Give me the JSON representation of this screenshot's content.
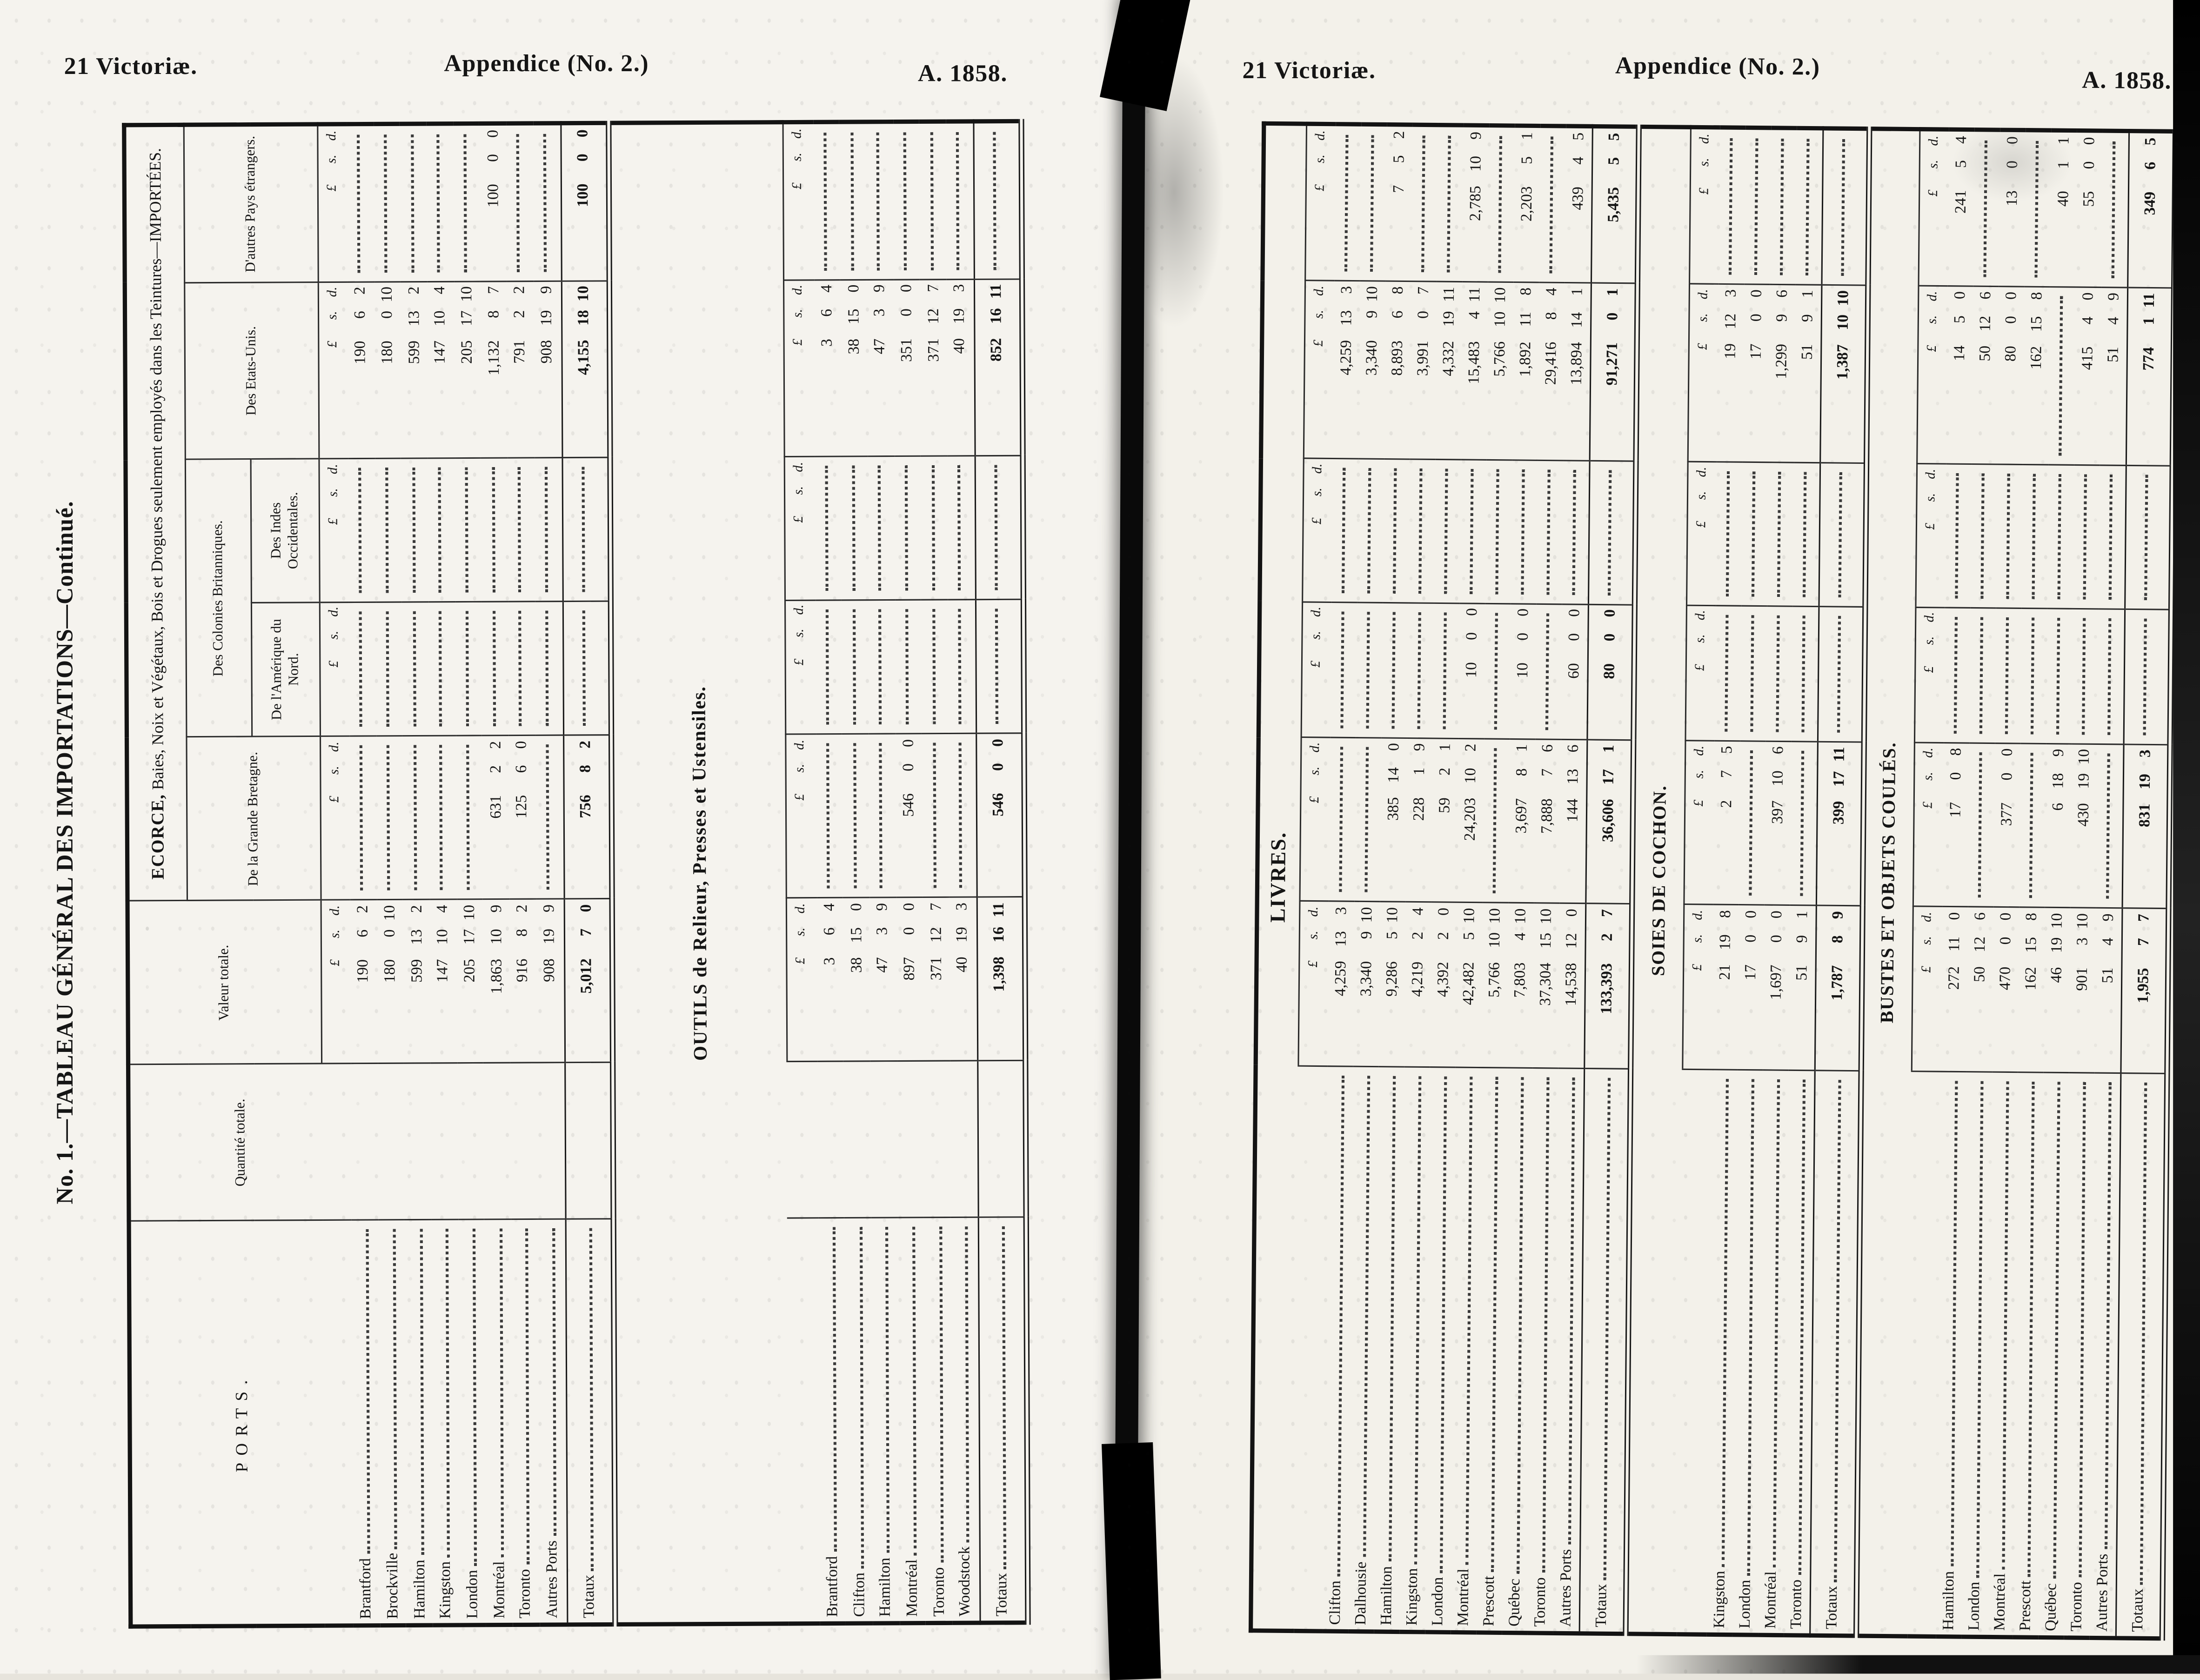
{
  "scan": {
    "header_left": "21 Victoriæ.",
    "header_center": "Appendice (No. 2.)",
    "header_right": "A. 1858.",
    "side_title": "No. 1.—TABLEAU GÉNÉRAL DES IMPORTATIONS—Continué."
  },
  "columns": {
    "ports": "PORTS.",
    "quantite": "Quantité totale.",
    "valeur": "Valeur totale.",
    "grande_bretagne": "De la Grande Bretagne.",
    "colonies": "Des Colonies Britanniques.",
    "amerique_nord": "De l'Amérique du Nord.",
    "indes_occidentales": "Des Indes Occidentales.",
    "etats_unis": "Des Etats-Unis.",
    "autres_pays": "D'autres Pays étrangers.",
    "totaux_label": "Totaux",
    "currency": {
      "l": "£",
      "s": "s.",
      "d": "d."
    }
  },
  "left_page": {
    "group_title_caps": "ECORCE,",
    "group_title_rest": " Baies, Noix et Végétaux, Bois et Drogues seulement employés dans les Teintures—IMPORTÉES.",
    "sections": [
      {
        "title": "",
        "rows": [
          {
            "port": "Brantford",
            "valeur": "190 6 2",
            "gb": "",
            "am": "",
            "in": "",
            "eu": "190 6 2",
            "au": ""
          },
          {
            "port": "Brockville",
            "valeur": "180 0 10",
            "gb": "",
            "am": "",
            "in": "",
            "eu": "180 0 10",
            "au": ""
          },
          {
            "port": "Hamilton",
            "valeur": "599 13 2",
            "gb": "",
            "am": "",
            "in": "",
            "eu": "599 13 2",
            "au": ""
          },
          {
            "port": "Kingston",
            "valeur": "147 10 4",
            "gb": "",
            "am": "",
            "in": "",
            "eu": "147 10 4",
            "au": ""
          },
          {
            "port": "London",
            "valeur": "205 17 10",
            "gb": "",
            "am": "",
            "in": "",
            "eu": "205 17 10",
            "au": ""
          },
          {
            "port": "Montréal",
            "valeur": "1,863 10 9",
            "gb": "631 2 2",
            "am": "",
            "in": "",
            "eu": "1,132 8 7",
            "au": "100 0 0"
          },
          {
            "port": "Toronto",
            "valeur": "916 8 2",
            "gb": "125 6 0",
            "am": "",
            "in": "",
            "eu": "791 2 2",
            "au": ""
          },
          {
            "port": "Autres Ports",
            "valeur": "908 19 9",
            "gb": "",
            "am": "",
            "in": "",
            "eu": "908 19 9",
            "au": ""
          }
        ],
        "totals": {
          "valeur": "5,012 7 0",
          "gb": "756 8 2",
          "am": "",
          "in": "",
          "eu": "4,155 18 10",
          "au": "100 0 0"
        }
      },
      {
        "title": "OUTILS de Relieur, Presses et Ustensiles.",
        "rows": [
          {
            "port": "Brantford",
            "valeur": "3 6 4",
            "gb": "",
            "am": "",
            "in": "",
            "eu": "3 6 4",
            "au": ""
          },
          {
            "port": "Clifton",
            "valeur": "38 15 0",
            "gb": "",
            "am": "",
            "in": "",
            "eu": "38 15 0",
            "au": ""
          },
          {
            "port": "Hamilton",
            "valeur": "47 3 9",
            "gb": "",
            "am": "",
            "in": "",
            "eu": "47 3 9",
            "au": ""
          },
          {
            "port": "Montréal",
            "valeur": "897 0 0",
            "gb": "546 0 0",
            "am": "",
            "in": "",
            "eu": "351 0 0",
            "au": ""
          },
          {
            "port": "Toronto",
            "valeur": "371 12 7",
            "gb": "",
            "am": "",
            "in": "",
            "eu": "371 12 7",
            "au": ""
          },
          {
            "port": "Woodstock",
            "valeur": "40 19 3",
            "gb": "",
            "am": "",
            "in": "",
            "eu": "40 19 3",
            "au": ""
          }
        ],
        "totals": {
          "valeur": "1,398 16 11",
          "gb": "546 0 0",
          "am": "",
          "in": "",
          "eu": "852 16 11",
          "au": ""
        }
      }
    ]
  },
  "right_page": {
    "sections": [
      {
        "title": "LIVRES.",
        "rows": [
          {
            "port": "Clifton",
            "valeur": "4,259 13 3",
            "gb": "",
            "am": "",
            "in": "",
            "eu": "4,259 13 3",
            "au": ""
          },
          {
            "port": "Dalhousie",
            "valeur": "3,340 9 10",
            "gb": "",
            "am": "",
            "in": "",
            "eu": "3,340 9 10",
            "au": ""
          },
          {
            "port": "Hamilton",
            "valeur": "9,286 5 10",
            "gb": "385 14 0",
            "am": "",
            "in": "",
            "eu": "8,893 6 8",
            "au": "7 5 2"
          },
          {
            "port": "Kingston",
            "valeur": "4,219 2 4",
            "gb": "228 1 9",
            "am": "",
            "in": "",
            "eu": "3,991 0 7",
            "au": ""
          },
          {
            "port": "London",
            "valeur": "4,392 2 0",
            "gb": "59 2 1",
            "am": "",
            "in": "",
            "eu": "4,332 19 11",
            "au": ""
          },
          {
            "port": "Montréal",
            "valeur": "42,482 5 10",
            "gb": "24,203 10 2",
            "am": "10 0 0",
            "in": "",
            "eu": "15,483 4 11",
            "au": "2,785 10 9"
          },
          {
            "port": "Prescott",
            "valeur": "5,766 10 10",
            "gb": "",
            "am": "",
            "in": "",
            "eu": "5,766 10 10",
            "au": ""
          },
          {
            "port": "Québec",
            "valeur": "7,803 4 10",
            "gb": "3,697 8 1",
            "am": "10 0 0",
            "in": "",
            "eu": "1,892 11 8",
            "au": "2,203 5 1"
          },
          {
            "port": "Toronto",
            "valeur": "37,304 15 10",
            "gb": "7,888 7 6",
            "am": "",
            "in": "",
            "eu": "29,416 8 4",
            "au": ""
          },
          {
            "port": "Autres Ports",
            "valeur": "14,538 12 0",
            "gb": "144 13 6",
            "am": "60 0 0",
            "in": "",
            "eu": "13,894 14 1",
            "au": "439 4 5"
          }
        ],
        "totals": {
          "valeur": "133,393 2 7",
          "gb": "36,606 17 1",
          "am": "80 0 0",
          "in": "",
          "eu": "91,271 0 1",
          "au": "5,435 5 5"
        }
      },
      {
        "title": "SOIES DE COCHON.",
        "rows": [
          {
            "port": "Kingston",
            "valeur": "21 19 8",
            "gb": "2 7 5",
            "am": "",
            "in": "",
            "eu": "19 12 3",
            "au": ""
          },
          {
            "port": "London",
            "valeur": "17 0 0",
            "gb": "",
            "am": "",
            "in": "",
            "eu": "17 0 0",
            "au": ""
          },
          {
            "port": "Montréal",
            "valeur": "1,697 0 0",
            "gb": "397 10 6",
            "am": "",
            "in": "",
            "eu": "1,299 9 6",
            "au": ""
          },
          {
            "port": "Toronto",
            "valeur": "51 9 1",
            "gb": "",
            "am": "",
            "in": "",
            "eu": "51 9 1",
            "au": ""
          }
        ],
        "totals": {
          "valeur": "1,787 8 9",
          "gb": "399 17 11",
          "am": "",
          "in": "",
          "eu": "1,387 10 10",
          "au": ""
        }
      },
      {
        "title": "BUSTES ET OBJETS COULÉS.",
        "rows": [
          {
            "port": "Hamilton",
            "valeur": "272 11 0",
            "gb": "17 0 8",
            "am": "",
            "in": "",
            "eu": "14 5 0",
            "au": "241 5 4"
          },
          {
            "port": "London",
            "valeur": "50 12 6",
            "gb": "",
            "am": "",
            "in": "",
            "eu": "50 12 6",
            "au": ""
          },
          {
            "port": "Montréal",
            "valeur": "470 0 0",
            "gb": "377 0 0",
            "am": "",
            "in": "",
            "eu": "80 0 0",
            "au": "13 0 0"
          },
          {
            "port": "Prescott",
            "valeur": "162 15 8",
            "gb": "",
            "am": "",
            "in": "",
            "eu": "162 15 8",
            "au": ""
          },
          {
            "port": "Québec",
            "valeur": "46 19 10",
            "gb": "6 18 9",
            "am": "",
            "in": "",
            "eu": "",
            "au": "40 1 1"
          },
          {
            "port": "Toronto",
            "valeur": "901 3 10",
            "gb": "430 19 10",
            "am": "",
            "in": "",
            "eu": "415 4 0",
            "au": "55 0 0"
          },
          {
            "port": "Autres Ports",
            "valeur": "51 4 9",
            "gb": "",
            "am": "",
            "in": "",
            "eu": "51 4 9",
            "au": ""
          }
        ],
        "totals": {
          "valeur": "1,955 7 7",
          "gb": "831 19 3",
          "am": "",
          "in": "",
          "eu": "774 1 11",
          "au": "349 6 5"
        }
      }
    ]
  }
}
